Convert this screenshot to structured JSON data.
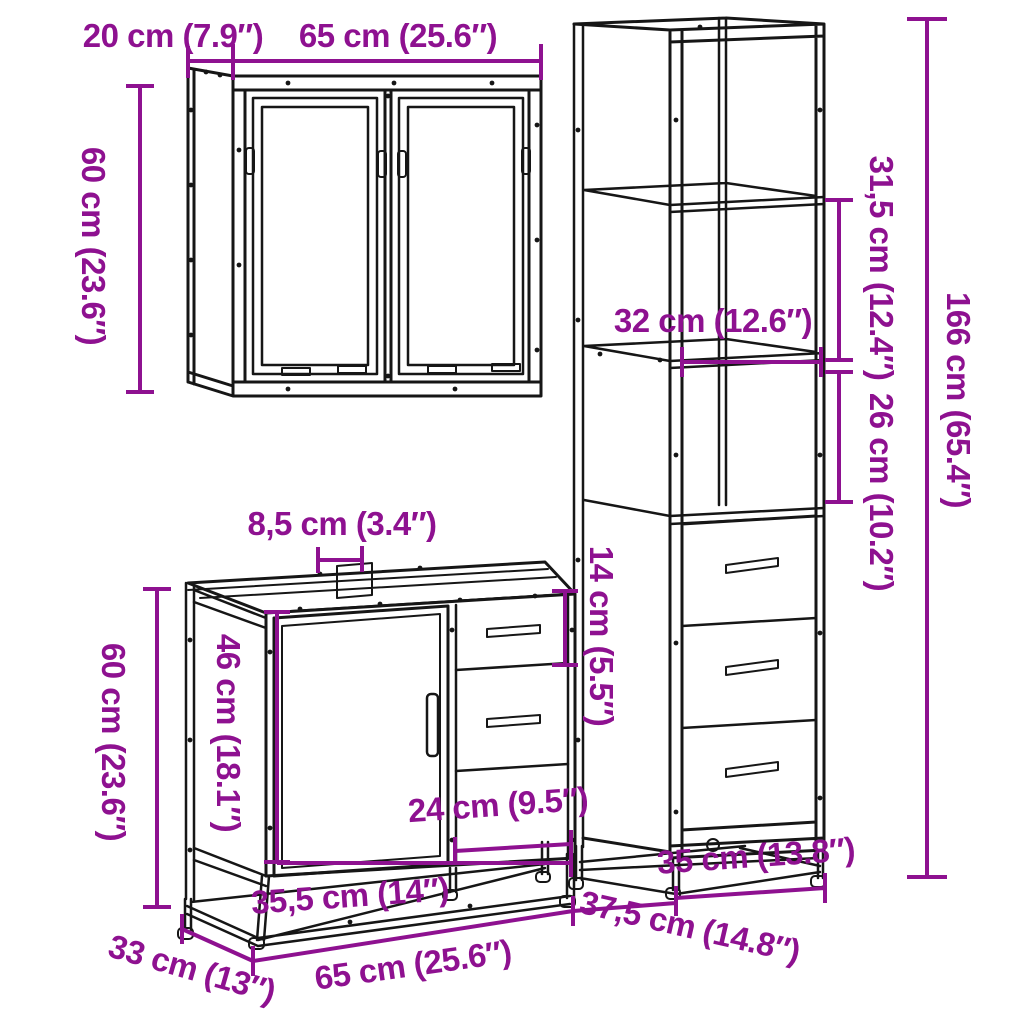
{
  "title": "3-piece bathroom furniture set dimension diagram",
  "colors": {
    "dimension": "#8E1190",
    "line": "#161616",
    "background": "#ffffff"
  },
  "units": {
    "metric": "cm",
    "imperial": "in"
  },
  "labels": {
    "mirror_depth": "20 cm (7.9″)",
    "mirror_width": "65 cm (25.6″)",
    "mirror_height": "60 cm (23.6″)",
    "tall_shelf_upper": "31,5 cm (12.4″)",
    "tall_shelf_width": "32 cm (12.6″)",
    "tall_shelf_lower": "26 cm (10.2″)",
    "tall_height": "166 cm (65.4″)",
    "tall_width": "35 cm (13.8″)",
    "tall_depth": "37,5 cm (14.8″)",
    "vanity_gap": "8,5 cm (3.4″)",
    "vanity_height": "60 cm (23.6″)",
    "vanity_door_height": "46 cm (18.1″)",
    "vanity_drawer_height": "14 cm (5.5″)",
    "vanity_drawer_width": "24 cm (9.5″)",
    "vanity_inner_width": "35,5 cm (14″)",
    "vanity_depth": "33 cm (13″)",
    "vanity_width": "65 cm (25.6″)"
  }
}
